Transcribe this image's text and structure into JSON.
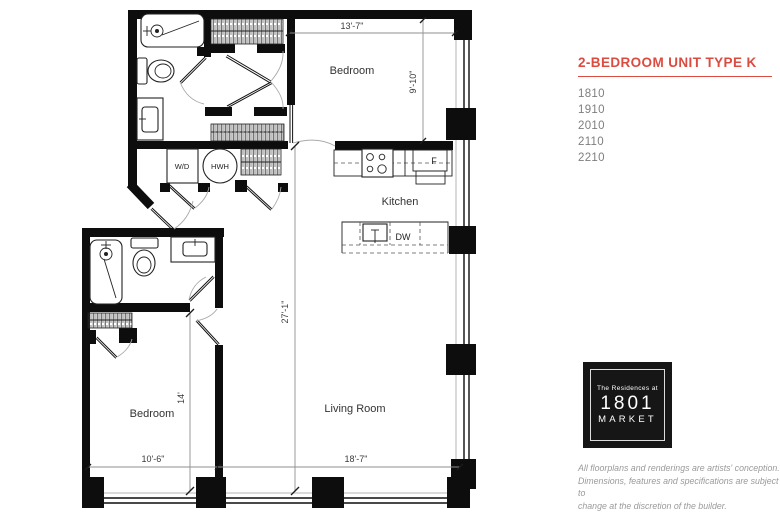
{
  "colors": {
    "accent_red": "#DC4B3F",
    "floor_text_gray": "#7E7E7E",
    "disclaimer_gray": "#9A9A9A",
    "wall_black": "#0d0d0d",
    "logo_background": "#161616"
  },
  "sidebar": {
    "title": "2-BEDROOM UNIT TYPE K",
    "floors": [
      "1810",
      "1910",
      "2010",
      "2110",
      "2210"
    ],
    "logo": {
      "line1": "The Residences at",
      "line2": "1801",
      "line3": "MARKET"
    },
    "disclaimer": {
      "lines": [
        "All floorplans and renderings are artists' conception.",
        "Dimensions, features and specifications are subject to",
        "change at the discretion of the builder."
      ]
    }
  },
  "floorplan": {
    "rooms": {
      "bedroom1": "Bedroom",
      "bedroom2": "Bedroom",
      "kitchen": "Kitchen",
      "living_room": "Living Room"
    },
    "fixtures": {
      "washer_dryer": "W/D",
      "water_heater": "HWH",
      "dishwasher": "DW",
      "fridge": "F"
    },
    "dimensions": {
      "bedroom1_width": "13'-7\"",
      "bedroom1_depth": "9'-10\"",
      "unit_depth": "27'-1\"",
      "bedroom2_depth": "14'",
      "bedroom2_width": "10'-6\"",
      "living_room_width": "18'-7\""
    }
  }
}
